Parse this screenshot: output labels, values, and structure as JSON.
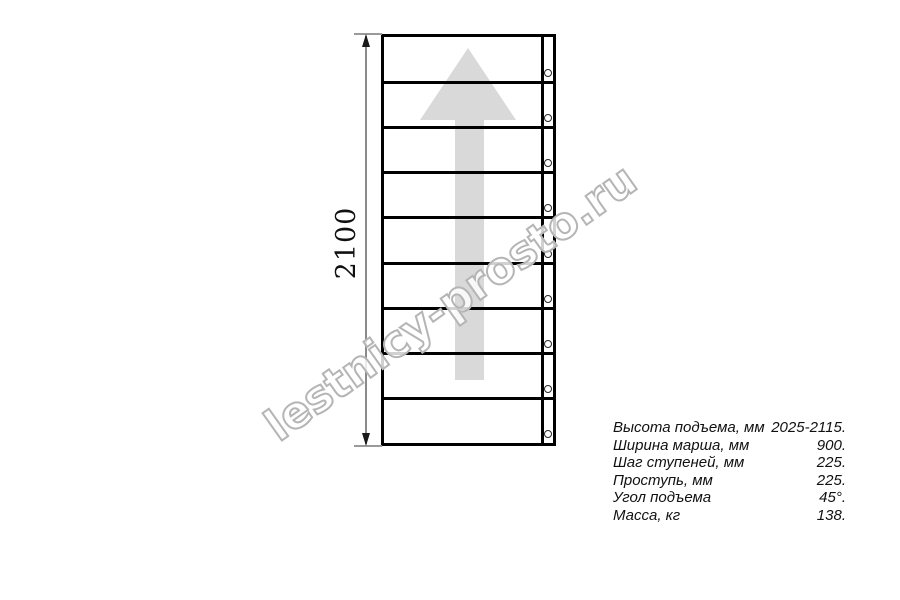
{
  "watermark": {
    "text": "lestnicy-prosto.ru"
  },
  "drawing": {
    "type": "staircase-plan-top-view",
    "dimension_label": "2100",
    "steps_count": 9,
    "bolts_count": 9
  },
  "colors": {
    "line": "#000000",
    "arrow_fill": "#d9d9d9",
    "dimension_line": "#8a8a8a",
    "watermark_outline": "#b5b5b5"
  },
  "specs": {
    "rows": [
      {
        "label": "Высота подъема, мм",
        "value": "2025-2115."
      },
      {
        "label": "Ширина марша, мм",
        "value": "900."
      },
      {
        "label": "Шаг ступеней, мм",
        "value": "225."
      },
      {
        "label": "Проступь, мм",
        "value": "225."
      },
      {
        "label": "Угол подъема",
        "value": "45°."
      },
      {
        "label": "Масса, кг",
        "value": "138."
      }
    ]
  }
}
